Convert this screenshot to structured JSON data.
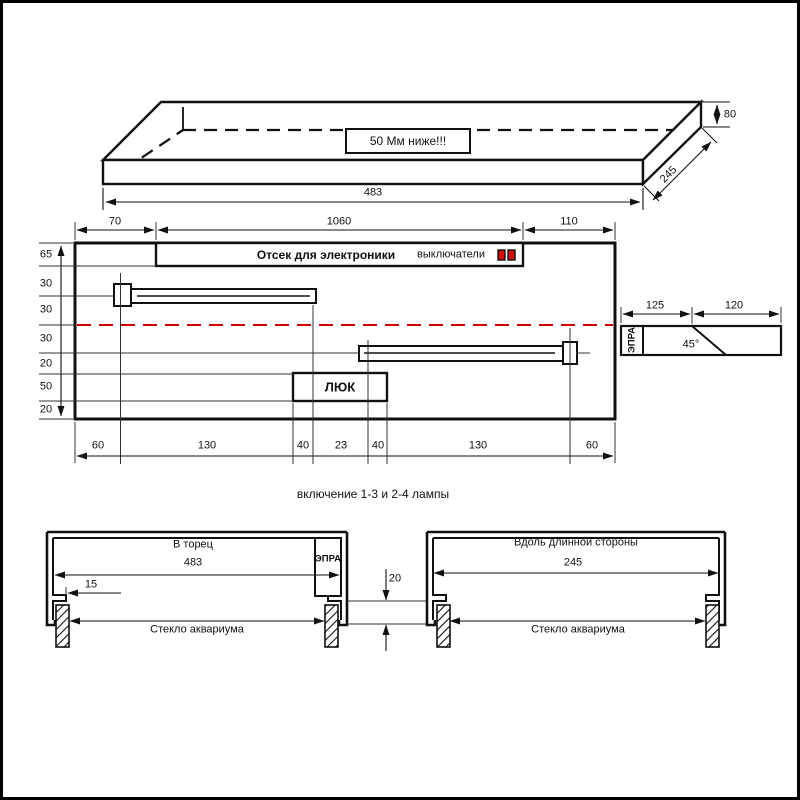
{
  "drawing": {
    "iso_view": {
      "note_label": "50 Мм ниже!!!",
      "dim_width": "483",
      "dim_depth": "245",
      "dim_height": "80"
    },
    "plan_view": {
      "top_dims": [
        "70",
        "1060",
        "110"
      ],
      "left_dims": [
        "65",
        "30",
        "30",
        "30",
        "20",
        "50",
        "20"
      ],
      "bottom_dims": [
        "60",
        "130",
        "40",
        "23",
        "40",
        "130",
        "60"
      ],
      "electronics_label": "Отсек для электроники",
      "switches_label": "выключатели",
      "hatch_label": "ЛЮК"
    },
    "ballast_view": {
      "ballast_label": "ЭПРА",
      "dim_left": "125",
      "dim_right": "120",
      "angle_label": "45°"
    },
    "caption": "включение 1-3 и 2-4 лампы",
    "section_end": {
      "title": "В торец",
      "dim": "483",
      "ballast_label": "ЭПРА",
      "lip_dim": "15",
      "glass_label": "Стекло аквариума"
    },
    "section_long": {
      "title": "Вдоль длинной стороны",
      "dim": "245",
      "glass_label": "Стекло аквариума"
    },
    "gap_dim": "20",
    "colors": {
      "line": "#111111",
      "centerline": "#cc0000",
      "switch_red": "#cc1111"
    }
  }
}
